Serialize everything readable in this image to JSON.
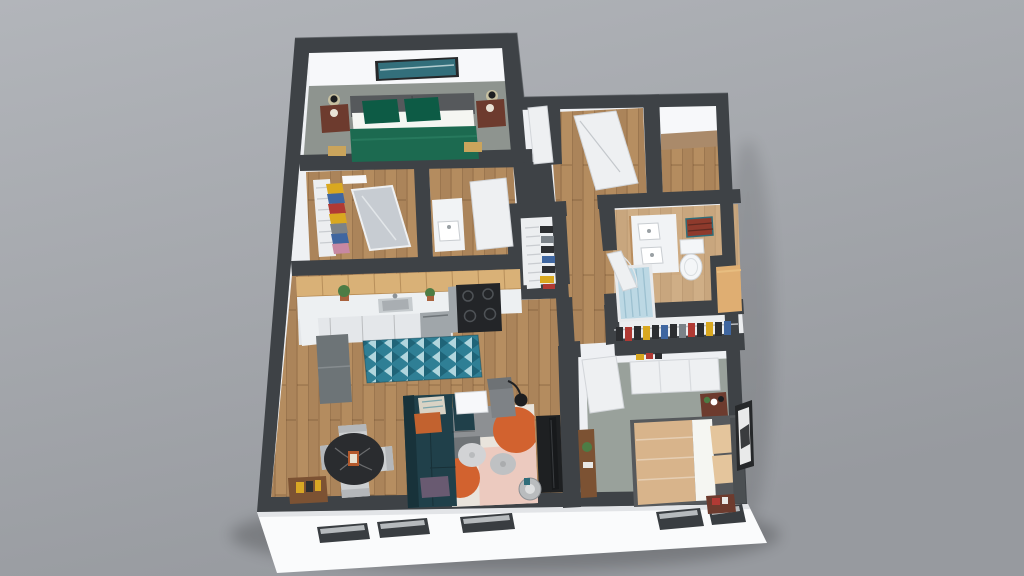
{
  "scene": {
    "title": "3D Apartment Floor Plan Render",
    "type": "isometric-dollhouse-floorplan",
    "background": "plain gray studio backdrop",
    "viewport": {
      "width": 1024,
      "height": 576
    }
  },
  "rooms": [
    {
      "name": "bedroom-1",
      "floor": "gray carpet",
      "furniture": [
        "double bed with green duvet",
        "two brown nightstands",
        "two wall lamps",
        "teal wall art",
        "two gold foot stools"
      ]
    },
    {
      "name": "walk-in-closet",
      "floor": "wood",
      "furniture": [
        "white clothes rack with yellow, blue, red and pink garments",
        "leaning mirror door"
      ]
    },
    {
      "name": "vanity-room",
      "floor": "wood",
      "furniture": [
        "white washbasin cabinet",
        "round mirror",
        "open white door"
      ]
    },
    {
      "name": "shoe-closet",
      "floor": "white",
      "furniture": [
        "white ladder shoe rack",
        "dark shoes"
      ]
    },
    {
      "name": "entry-hall",
      "floor": "wood",
      "furniture": [
        "open white front door",
        "open bedroom door"
      ]
    },
    {
      "name": "foyer-room",
      "floor": "wood",
      "furniture": []
    },
    {
      "name": "kitchen",
      "floor": "wood",
      "furniture": [
        "wood upper cabinets",
        "white counter with sink",
        "stainless stove with black cooktop",
        "dishwasher",
        "white lower cabinets",
        "gray fridge",
        "potted plants",
        "teal patterned runner rug"
      ]
    },
    {
      "name": "dining-area",
      "floor": "wood",
      "furniture": [
        "round black marble table",
        "four light gray chairs",
        "wood sideboard with yellow books"
      ]
    },
    {
      "name": "living-room",
      "floor": "wood",
      "furniture": [
        "dark teal sectional sofa",
        "orange, cream and purple pillows",
        "white side table",
        "gray armchair",
        "black arc floor lamp",
        "abstract cream/pink/orange rug",
        "two round poufs",
        "black media console with TV",
        "round metal side table"
      ]
    },
    {
      "name": "bathroom",
      "floor": "light wood",
      "furniture": [
        "white double-sink vanity",
        "toilet",
        "red wall shelf",
        "bathtub with light blue curtain",
        "tan linen cabinet",
        "open door"
      ]
    },
    {
      "name": "wardrobe-corridor",
      "floor": "white",
      "furniture": [
        "built-in closet with hanging clothes"
      ]
    },
    {
      "name": "bedroom-2",
      "floor": "gray carpet",
      "furniture": [
        "double bed with tan blanket and gray frame",
        "two dark red nightstands",
        "black framed wall art",
        "wood desk with plant",
        "white sliding closet",
        "open white door"
      ]
    }
  ],
  "palette": {
    "bg_top": "#b2b5ba",
    "bg_bottom": "#979a9f",
    "wall_cap": "#3e4246",
    "wall_cap_edge": "#5a5e63",
    "wall_face": "#eef0f3",
    "wall_face_bright": "#f7f8fa",
    "ext_face": "#fafbfc",
    "window_slot": "#393d41",
    "wood": "#b28a5e",
    "wood_dark": "#9c7750",
    "wood_light": "#c49b6c",
    "wood_pale": "#cfae86",
    "carpet_1": "#8e948f",
    "carpet_2": "#99a19b",
    "green_duvet": "#1c6a50",
    "green_pillow": "#0d5b45",
    "sheet_white": "#f5f6f2",
    "headboard": "#56595c",
    "nightstand": "#6d3b2e",
    "art_teal": "#336f7b",
    "frame_dark": "#26282a",
    "mirror_gray": "#c7ccd2",
    "door_white": "#eef0f2",
    "door_edge": "#d2d5d9",
    "cab_wood": "#d9b177",
    "counter": "#edf0f2",
    "cab_white": "#e4e7ea",
    "steel": "#a0a6aa",
    "stove_top": "#232528",
    "fridge": "#6d7477",
    "rug_teal": "#2f7f95",
    "rug_teal_dark": "#1f6478",
    "rug_teal_light": "#bfe0e6",
    "sofa": "#20404a",
    "pillow_orange": "#c2622f",
    "pillow_purple": "#695a71",
    "pillow_cream": "#d9d3c5",
    "rug_cream": "#e9e4dc",
    "rug_pink": "#eccabf",
    "rug_orange": "#d2622f",
    "rug_gray": "#8d9093",
    "rug_gray_dark": "#707477",
    "pouf": "#d2d3d5",
    "pouf_dark": "#bfc1c3",
    "tv_black": "#17191b",
    "console_black": "#1e2022",
    "table_black": "#2a2c2f",
    "chair_gray": "#cccfd1",
    "sideboard": "#7c5233",
    "book_yellow": "#d9a724",
    "tan_blanket": "#d8b48b",
    "tan_pillow": "#e4c59c",
    "bath_vanity": "#f1f3f5",
    "toilet": "#f4f6f8",
    "shelf_red": "#8e3a2c",
    "curtain": "#bcd8e4",
    "linen_tan": "#dfae72",
    "rack_white": "#eceef0",
    "cloth_yellow": "#d9a820",
    "cloth_red": "#b03a34",
    "cloth_blue": "#3f66a0",
    "cloth_dark": "#2c2e31",
    "plant": "#4d7c45",
    "pot": "#a9623d",
    "lamp_dark": "#1d1e20",
    "metal": "#b9bcbe"
  }
}
